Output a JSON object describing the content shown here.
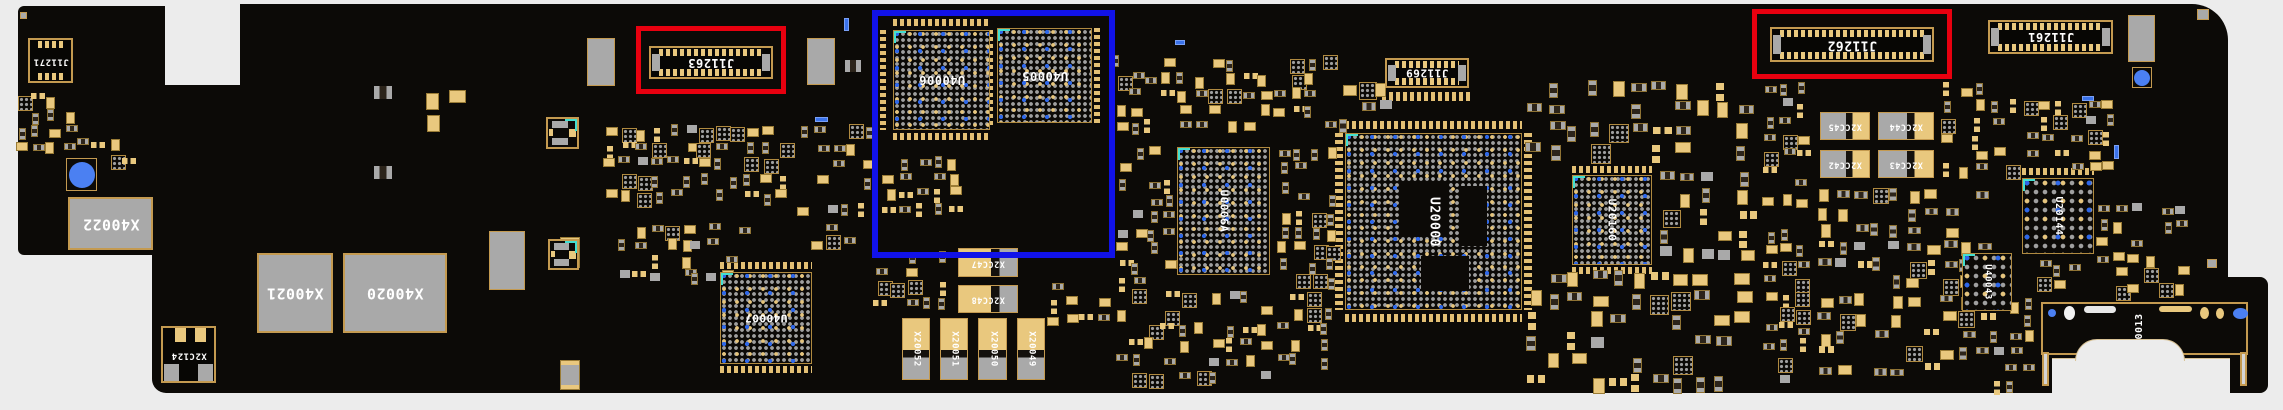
{
  "view": {
    "kind": "pcb-board-silkscreen-view",
    "board_side_text_orientation": "mirrored-180"
  },
  "colors": {
    "page_bg": "#ececec",
    "board": "#0c0a07",
    "pad_tan": "#e9c87e",
    "pad_gray": "#a9a9a9",
    "silk_gold": "#c49a50",
    "label_white": "#ffffff",
    "highlight_red": "#e8000f",
    "highlight_blue": "#1112e8",
    "screw_hole_blue": "#4b80f2",
    "corner_mark_teal": "#43dfd0",
    "ball_blue": "#2e67e8"
  },
  "highlights": [
    {
      "id": "red-box-1",
      "color": "#e8000f",
      "around_refdes": "J11263"
    },
    {
      "id": "red-box-2",
      "color": "#e8000f",
      "around_refdes": "J11262"
    },
    {
      "id": "blue-box-1",
      "color": "#1112e8",
      "around_refdes": "U40006 U40005"
    }
  ],
  "components": [
    {
      "refdes": "J11271",
      "kind": "connector"
    },
    {
      "refdes": "X40022",
      "kind": "shield-pad"
    },
    {
      "refdes": "X2C124",
      "kind": "ic"
    },
    {
      "refdes": "X40021",
      "kind": "shield-pad"
    },
    {
      "refdes": "X40020",
      "kind": "shield-pad"
    },
    {
      "refdes": "J11263",
      "kind": "connector"
    },
    {
      "refdes": "U40006",
      "kind": "bga-ic"
    },
    {
      "refdes": "U40005",
      "kind": "bga-ic"
    },
    {
      "refdes": "U40007",
      "kind": "bga-ic"
    },
    {
      "refdes": "U0006A",
      "kind": "bga-ic"
    },
    {
      "refdes": "X2CC47",
      "kind": "contact-pad"
    },
    {
      "refdes": "X2CC48",
      "kind": "contact-pad"
    },
    {
      "refdes": "X20052",
      "kind": "contact-pad"
    },
    {
      "refdes": "X20051",
      "kind": "contact-pad"
    },
    {
      "refdes": "X20050",
      "kind": "contact-pad"
    },
    {
      "refdes": "X20049",
      "kind": "contact-pad"
    },
    {
      "refdes": "J11269",
      "kind": "connector"
    },
    {
      "refdes": "U20000",
      "kind": "bga-soc"
    },
    {
      "refdes": "U20160",
      "kind": "bga-ic"
    },
    {
      "refdes": "X2CC45",
      "kind": "contact-pad"
    },
    {
      "refdes": "X2CC44",
      "kind": "contact-pad"
    },
    {
      "refdes": "X2CC42",
      "kind": "contact-pad"
    },
    {
      "refdes": "X2CC43",
      "kind": "contact-pad"
    },
    {
      "refdes": "J11262",
      "kind": "connector"
    },
    {
      "refdes": "J11261",
      "kind": "connector"
    },
    {
      "refdes": "U20144",
      "kind": "bga-ic"
    },
    {
      "refdes": "U40043",
      "kind": "bga-ic"
    },
    {
      "refdes": "J40013",
      "kind": "connector-footprint"
    }
  ]
}
